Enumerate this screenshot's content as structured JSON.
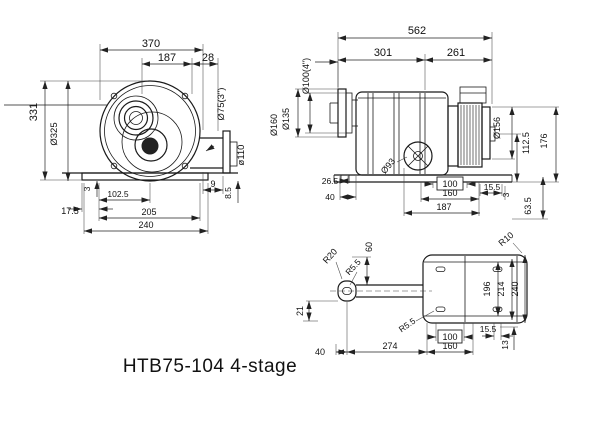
{
  "caption": "HTB75-104 4-stage",
  "colors": {
    "line": "#1a1a1a",
    "background": "#ffffff"
  },
  "front_view": {
    "overall_width": "370",
    "inlet_offset": "187",
    "outlet_offset": "28",
    "outlet_pipe_dia": "Ø75(3\")",
    "outlet_flange_dia": "ø110",
    "overall_height": "331",
    "housing_dia": "Ø325",
    "base_lip": "3",
    "bolt_half_spacing": "102.5",
    "base_edge_offset": "17.5",
    "bolt_spacing": "205",
    "base_width": "240",
    "flange_gap": "9",
    "flange_thickness": "8.5"
  },
  "side_view": {
    "overall_length": "562",
    "housing_length": "301",
    "motor_length": "261",
    "inlet_pipe_dia": "Ø100(4\")",
    "inlet_flange_dia": "Ø160",
    "inlet_bolt_circle": "Ø135",
    "motor_dia": "Ø156",
    "shaft_height": "112.5",
    "motor_top_height": "176",
    "port_flange_dia": "Ø93",
    "foot_offset": "26.5",
    "foot_width": "40",
    "bolt_spacing_x": "100",
    "bolt_spacing_outer_x": "160",
    "base_length": "187",
    "slot_offset": "15.5",
    "slot_edge": "3",
    "base_height": "63.5"
  },
  "bottom_view": {
    "corner_radius": "R20",
    "tab_slot_radius": "R5.5",
    "tab_offset": "60",
    "plate_corner_radius": "R10",
    "bolt_span_y_inner": "196",
    "bolt_span_y_mid": "214",
    "plate_width": "240",
    "tab_drop": "21",
    "tab_width": "40",
    "slot_radius": "R5.5",
    "plate_length": "274",
    "bolt_span_x_inner": "100",
    "bolt_span_x_outer": "160",
    "slot_length": "15.5",
    "slot_edge_offset": "13"
  }
}
